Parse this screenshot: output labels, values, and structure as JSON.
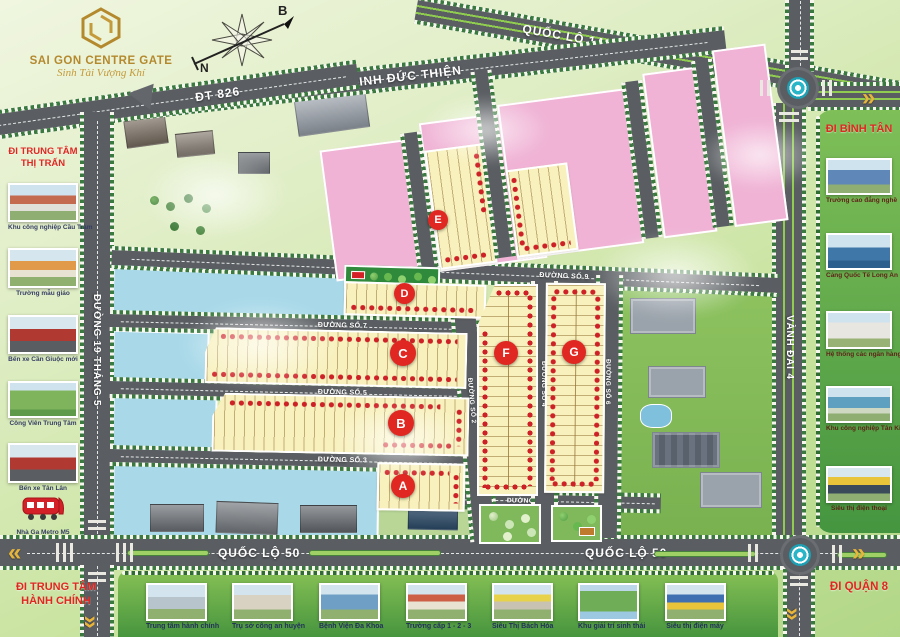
{
  "brand": {
    "name": "SAI GON CENTRE GATE",
    "tagline": "Sinh Tài Vượng Khí",
    "gold": "#b4892e"
  },
  "compass": {
    "north": "B",
    "south": "N"
  },
  "roads": {
    "ql1a": "QUỐC LỘ 1A",
    "dinh_duc_thien": "ĐINH ĐỨC THIỆN",
    "dt826": "ĐT 826",
    "d19thang5": "ĐƯỜNG 19 THÁNG 5",
    "vanhdai4": "VÀNH ĐAI 4",
    "ql50_left": "QUỐC LỘ 50",
    "ql50_right": "QUỐC LỘ 50",
    "so9_left": "ĐƯỜNG SỐ 9",
    "so9_right": "ĐƯỜNG SỐ 9",
    "so7": "ĐƯỜNG SỐ 7",
    "so5": "ĐƯỜNG SỐ 5",
    "so3": "ĐƯỜNG SỐ 3",
    "so1": "ĐƯỜNG SỐ 1",
    "so2": "ĐƯỜNG SỐ 2",
    "so4": "ĐƯỜNG SỐ 4",
    "so6": "ĐƯỜNG SỐ 6"
  },
  "blocks": {
    "a": "A",
    "b": "B",
    "c": "C",
    "d": "D",
    "e": "E",
    "f": "F",
    "g": "G"
  },
  "left_panel": {
    "heading_top": "ĐI TRUNG TÂM THỊ TRẤN",
    "heading_bottom": "ĐI TRUNG TÂM HÀNH CHÍNH",
    "items": [
      {
        "caption": "Khu công nghiệp Cầu Tràm"
      },
      {
        "caption": "Trường mẫu giáo"
      },
      {
        "caption": "Bến xe Cần Giuộc mới"
      },
      {
        "caption": "Công Viên Trung Tâm"
      },
      {
        "caption": "Bến xe Tân Lân"
      },
      {
        "caption": "Nhà Ga Metro M5"
      }
    ]
  },
  "right_panel": {
    "heading_top": "ĐI BÌNH TÂN",
    "heading_bottom": "ĐI QUẬN 8",
    "items": [
      {
        "caption": "Trường cao đẳng nghề"
      },
      {
        "caption": "Cảng Quốc Tế Long An"
      },
      {
        "caption": "Hệ thống các ngân hàng"
      },
      {
        "caption": "Khu công nghiệp Tân Kim"
      },
      {
        "caption": "Siêu thị điện thoại"
      }
    ]
  },
  "bottom_bar": {
    "items": [
      {
        "caption": "Trung tâm hành chính"
      },
      {
        "caption": "Trụ sở công an huyện"
      },
      {
        "caption": "Bệnh Viện Đa Khoa"
      },
      {
        "caption": "Trường cấp 1 - 2 - 3"
      },
      {
        "caption": "Siêu Thị Bách Hóa"
      },
      {
        "caption": "Khu giải trí sinh thái"
      },
      {
        "caption": "Siêu thị điện máy"
      }
    ]
  },
  "colors": {
    "road_gray": "#5a5e62",
    "lot_yellow": "#f8f1bd",
    "parcel_pink": "#f0b3d5",
    "water_cyan": "#a9d9e9",
    "marker_red": "#ce2127",
    "heading_red": "#e02722",
    "panel_green": "#459540",
    "arrow_gold": "#e8b53a"
  }
}
